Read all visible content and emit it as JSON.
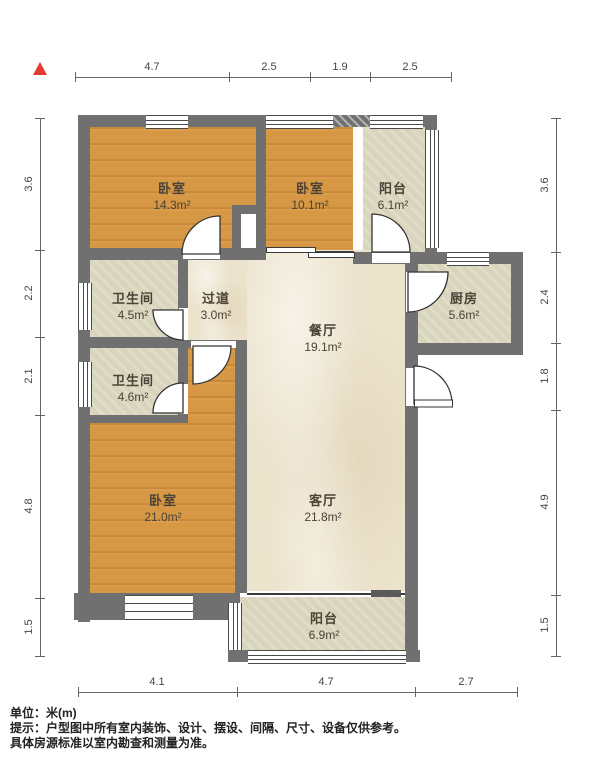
{
  "north": {
    "symbol": "north-arrow"
  },
  "dimensions": {
    "top": [
      "4.7",
      "2.5",
      "1.9",
      "2.5"
    ],
    "left": [
      "3.6",
      "2.2",
      "2.1",
      "4.8",
      "1.5"
    ],
    "right": [
      "3.6",
      "2.4",
      "1.8",
      "4.9",
      "1.5"
    ],
    "bottom": [
      "4.1",
      "4.7",
      "2.7"
    ]
  },
  "rooms": {
    "bedroom_top_left": {
      "name": "卧室",
      "area": "14.3m²"
    },
    "bedroom_top_mid": {
      "name": "卧室",
      "area": "10.1m²"
    },
    "balcony_top": {
      "name": "阳台",
      "area": "6.1m²"
    },
    "bathroom_upper": {
      "name": "卫生间",
      "area": "4.5m²"
    },
    "hallway": {
      "name": "过道",
      "area": "3.0m²"
    },
    "dining_room": {
      "name": "餐厅",
      "area": "19.1m²"
    },
    "kitchen": {
      "name": "厨房",
      "area": "5.6m²"
    },
    "bathroom_lower": {
      "name": "卫生间",
      "area": "4.6m²"
    },
    "bedroom_bottom": {
      "name": "卧室",
      "area": "21.0m²"
    },
    "living_room": {
      "name": "客厅",
      "area": "21.8m²"
    },
    "balcony_bottom": {
      "name": "阳台",
      "area": "6.9m²"
    }
  },
  "footer": {
    "unit": "单位：米(m)",
    "tip_line1": "提示：户型图中所有室内装饰、设计、摆设、间隔、尺寸、设备仅供参考。",
    "tip_line2": "具体房源标准以室内勘查和测量为准。"
  },
  "colors": {
    "wall": "#707070",
    "wood_floor": "#d69845",
    "tile_floor": "#d9d5bd",
    "marble_floor": "#ece3cd",
    "north_arrow": "#e23b2e",
    "dimension_text": "#444444"
  }
}
